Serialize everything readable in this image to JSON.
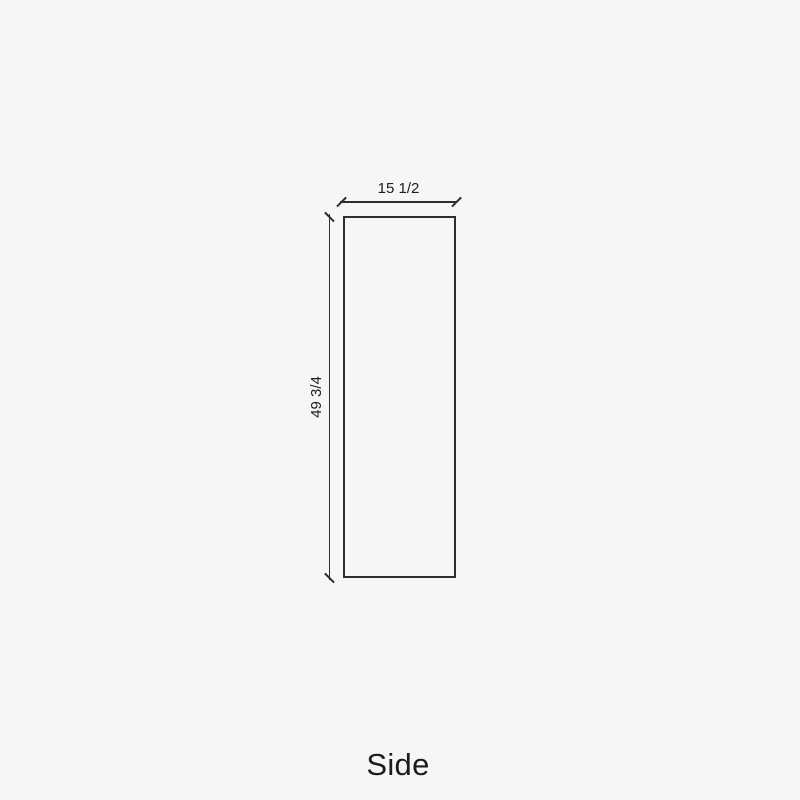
{
  "page": {
    "background_color": "#f6f6f6",
    "line_color": "#2e2e2e",
    "text_color": "#1c1c1c"
  },
  "diagram": {
    "view_caption": "Side",
    "panel": {
      "width_label": "15 1/2",
      "height_label": "49 3/4"
    }
  }
}
